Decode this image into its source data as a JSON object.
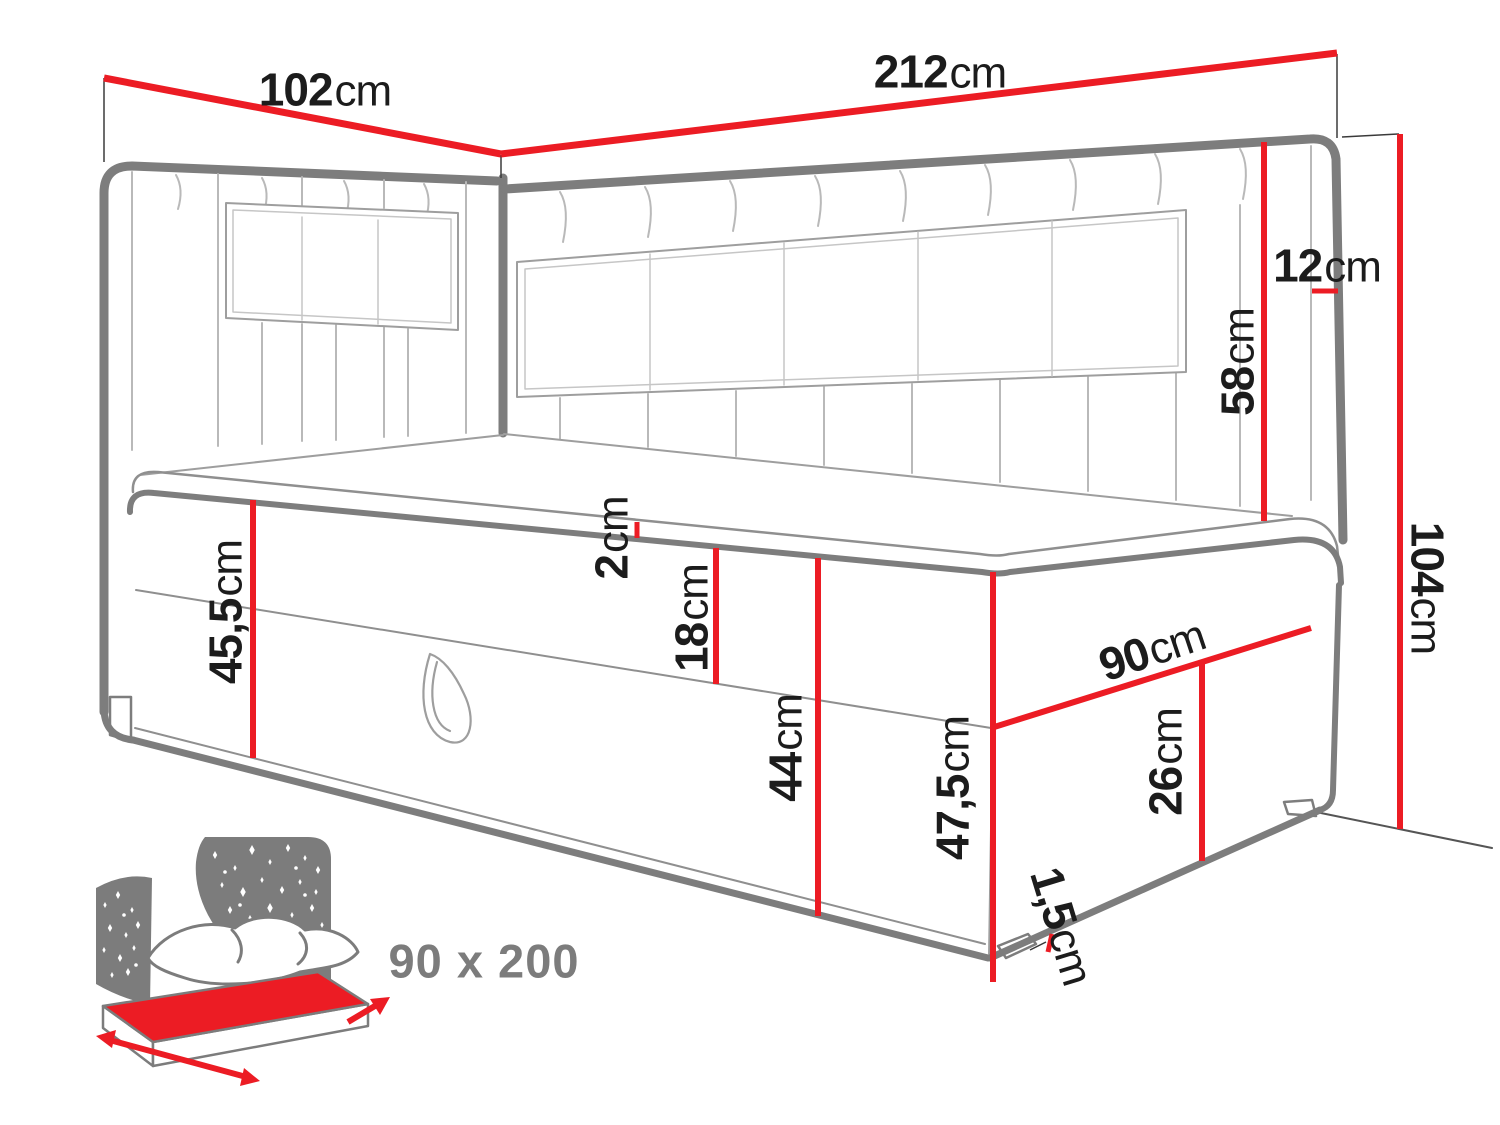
{
  "diagram": {
    "title": "corner-bed-dimension-drawing",
    "unit": "cm",
    "colors": {
      "dimension_red": "#ec1c24",
      "outline_gray": "#7d7d7d",
      "thin_gray": "#b3b3b3",
      "icon_gray": "#7c7c7c",
      "text_black": "#1c1c1c"
    }
  },
  "dims": {
    "headboard_side_width": {
      "value": "102",
      "unit": "cm"
    },
    "headboard_wall_width": {
      "value": "212",
      "unit": "cm"
    },
    "headboard_depth": {
      "value": "12",
      "unit": "cm"
    },
    "headboard_height": {
      "value": "58",
      "unit": "cm"
    },
    "overall_height": {
      "value": "104",
      "unit": "cm"
    },
    "topper_height": {
      "value": "2",
      "unit": "cm"
    },
    "mattress_box_height": {
      "value": "18",
      "unit": "cm"
    },
    "front_height": {
      "value": "45,5",
      "unit": "cm"
    },
    "base_height": {
      "value": "44",
      "unit": "cm"
    },
    "corner_height": {
      "value": "47,5",
      "unit": "cm"
    },
    "side_width": {
      "value": "90",
      "unit": "cm"
    },
    "container_height": {
      "value": "26",
      "unit": "cm"
    },
    "glide_height": {
      "value": "1,5",
      "unit": "cm"
    }
  },
  "icon": {
    "name": "mattress-size-icon",
    "size_label": "90 x 200"
  }
}
